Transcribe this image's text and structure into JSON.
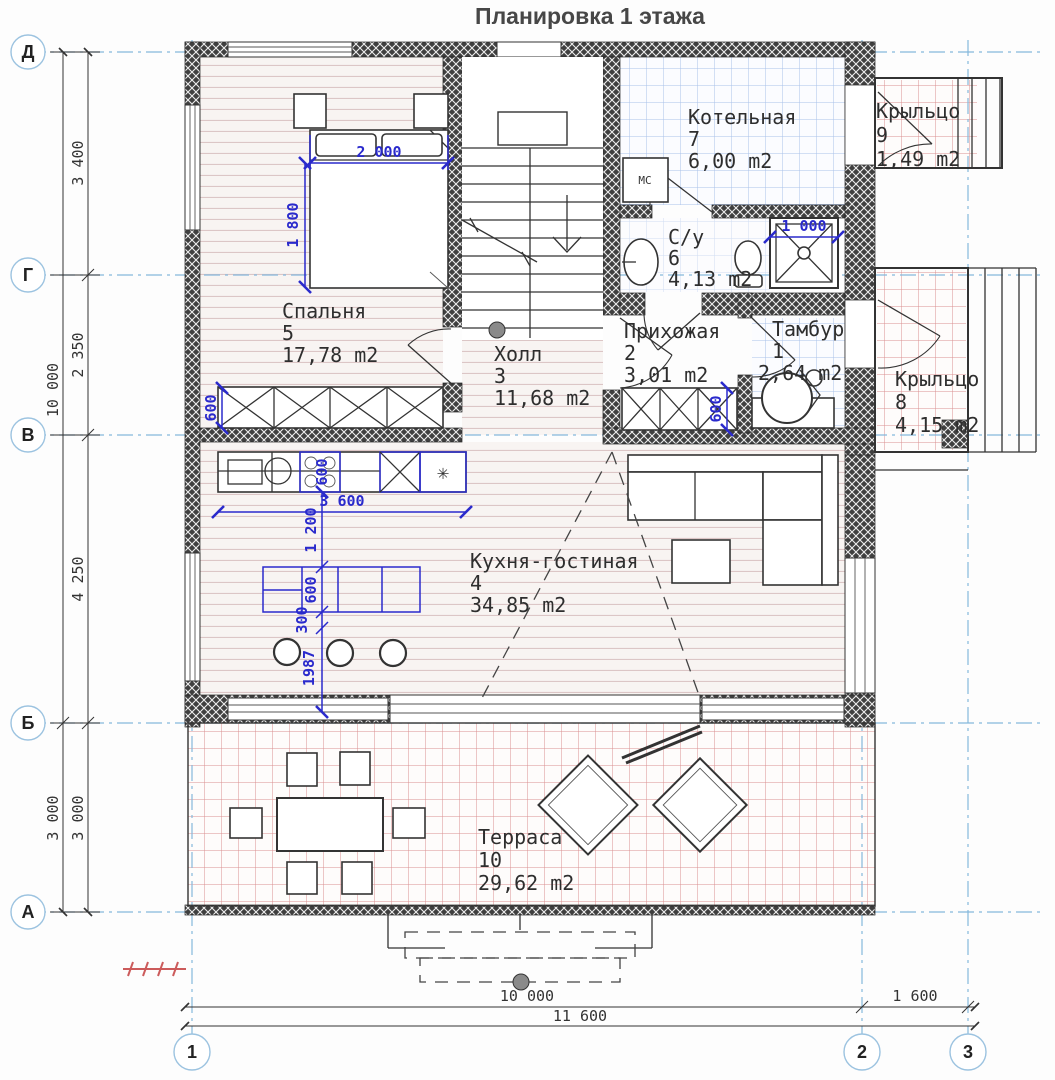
{
  "title": "Планировка 1 этажа",
  "rooms": {
    "tambur": {
      "name": "Тамбур",
      "num": "1",
      "area": "2,64 m2"
    },
    "prihozhaya": {
      "name": "Прихожая",
      "num": "2",
      "area": "3,01 m2"
    },
    "hall": {
      "name": "Холл",
      "num": "3",
      "area": "11,68 m2"
    },
    "kitchen": {
      "name": "Кухня-гостиная",
      "num": "4",
      "area": "34,85 m2"
    },
    "bedroom": {
      "name": "Спальня",
      "num": "5",
      "area": "17,78 m2"
    },
    "bathroom": {
      "name": "С/у",
      "num": "6",
      "area": "4,13 m2"
    },
    "boiler": {
      "name": "Котельная",
      "num": "7",
      "area": "6,00 m2"
    },
    "porch8": {
      "name": "Крыльцо",
      "num": "8",
      "area": "4,15 m2"
    },
    "porch9": {
      "name": "Крыльцо",
      "num": "9",
      "area": "1,49 m2"
    },
    "terrace": {
      "name": "Терраса",
      "num": "10",
      "area": "29,62 m2"
    }
  },
  "axis_rows": [
    "Д",
    "Г",
    "В",
    "Б",
    "А"
  ],
  "axis_cols": [
    "1",
    "2",
    "3"
  ],
  "dims": {
    "row_dg": "3 400",
    "row_gv": "2 350",
    "row_vb": "4 250",
    "row_ba": "3 000",
    "row_ba2": "3 000",
    "row_total": "10 000",
    "col_12": "10 000",
    "col_23": "1 600",
    "col_total": "11 600",
    "bed_w": "2 000",
    "bed_h": "1 800",
    "shower_w": "1 000",
    "counter_len": "3 600",
    "counter_depth": "600",
    "wardrobe_depth": "600",
    "hallway_depth": "600",
    "island_gap": "1 200",
    "island_w": "600",
    "island_off": "300",
    "island_wall": "1987"
  },
  "labels": {
    "washer": "МС",
    "freezer": "✳"
  },
  "colors": {
    "axis_blue": "#85b8dc",
    "dim_blue": "#2a2acc",
    "tile_blue": "#a9c2ea",
    "tile_red": "#d99090",
    "wood": "#dcc6c6",
    "wall": "#3f3f3f"
  }
}
